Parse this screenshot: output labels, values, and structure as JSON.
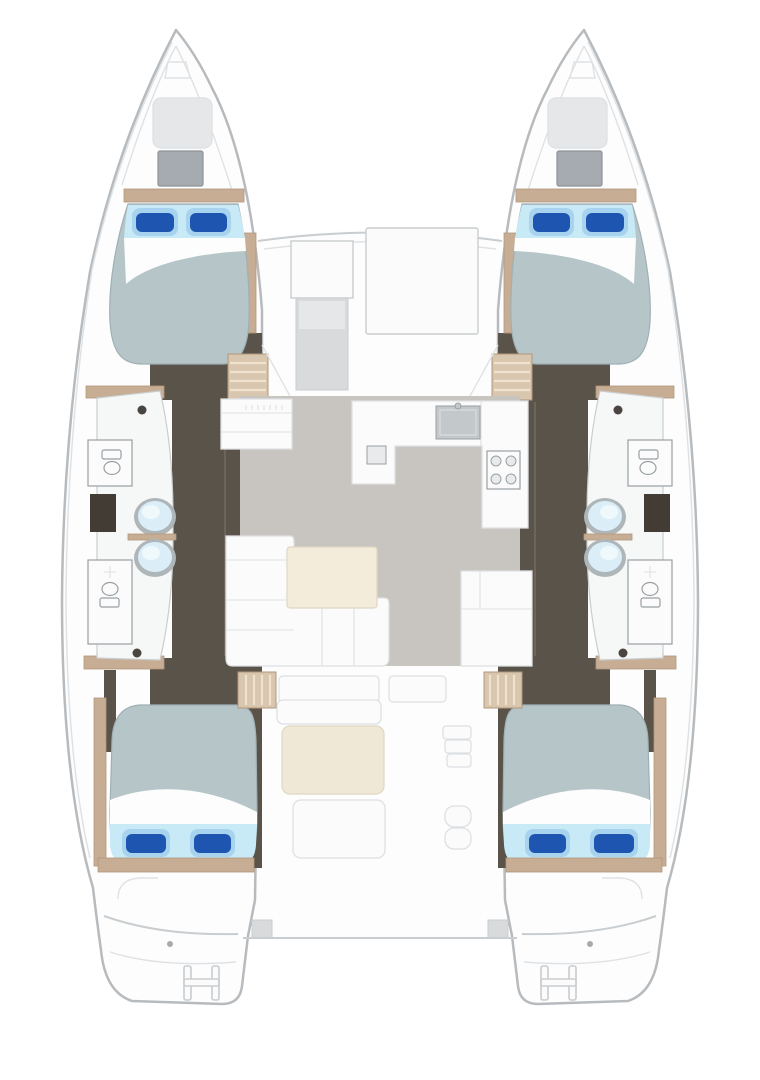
{
  "diagram": {
    "type": "catamaran-deck-floor-plan",
    "view": "top-down layout",
    "aria_label": "Catamaran yacht interior floor plan, top-down view",
    "spaces": {
      "double_cabins": 4,
      "bathrooms": 4,
      "wash_basins": 4,
      "toilets": 4,
      "saloon": 1,
      "galley": 1,
      "cockpit": 1,
      "bow_lockers": 2,
      "swim_platforms": 2
    },
    "features": [
      "port-forward-cabin",
      "port-aft-cabin",
      "starboard-forward-cabin",
      "starboard-aft-cabin",
      "port-bathrooms",
      "starboard-bathrooms",
      "saloon-sofa",
      "saloon-table",
      "galley-sink",
      "galley-stove",
      "cockpit-table",
      "cockpit-bench",
      "transom-ladder"
    ]
  },
  "colors": {
    "hull_fill": "#fdfdfe",
    "hull_outline": "#b7bbbe",
    "hull_line_soft": "#dfe2e4",
    "panel_line": "#c9cdcf",
    "hatch_gray": "#d8dadb",
    "hatch_gray_light": "#e5e7e8",
    "locker_gray": "#a5abb0",
    "locker_edge": "#8e9497",
    "corridor_floor": "#5a5349",
    "corridor_line": "#7a7165",
    "wood_trim": "#c7ad93",
    "wood_edge": "#b2977c",
    "wood_steps": "#d9c6ae",
    "wood_slat": "#efe2cf",
    "bath_floor": "#f6f7f7",
    "fixture_line": "#9aa0a3",
    "dark_block": "#423c35",
    "basin_rim": "#aeb6ba",
    "basin_fill": "#dbeef7",
    "basin_highlight": "#f2fafd",
    "pivot_dot": "#4a4540",
    "mattress": "#b6c5c8",
    "mattress_edge": "#9fb0b4",
    "bed_sheet_strip": "#c8e9f6",
    "pillow_light": "#a8d3ee",
    "pillow_dark": "#1e55b0",
    "salon_floor": "#c8c5c0",
    "furniture_white": "#fbfbfc",
    "furniture_line": "#dde0e3",
    "table_cream": "#f3ecda",
    "table_cream_edge": "#e0d7c2",
    "cockpit_table": "#efe8d6",
    "sink_gray": "#c3c8ca",
    "burner_fill": "#e8eaeb"
  }
}
